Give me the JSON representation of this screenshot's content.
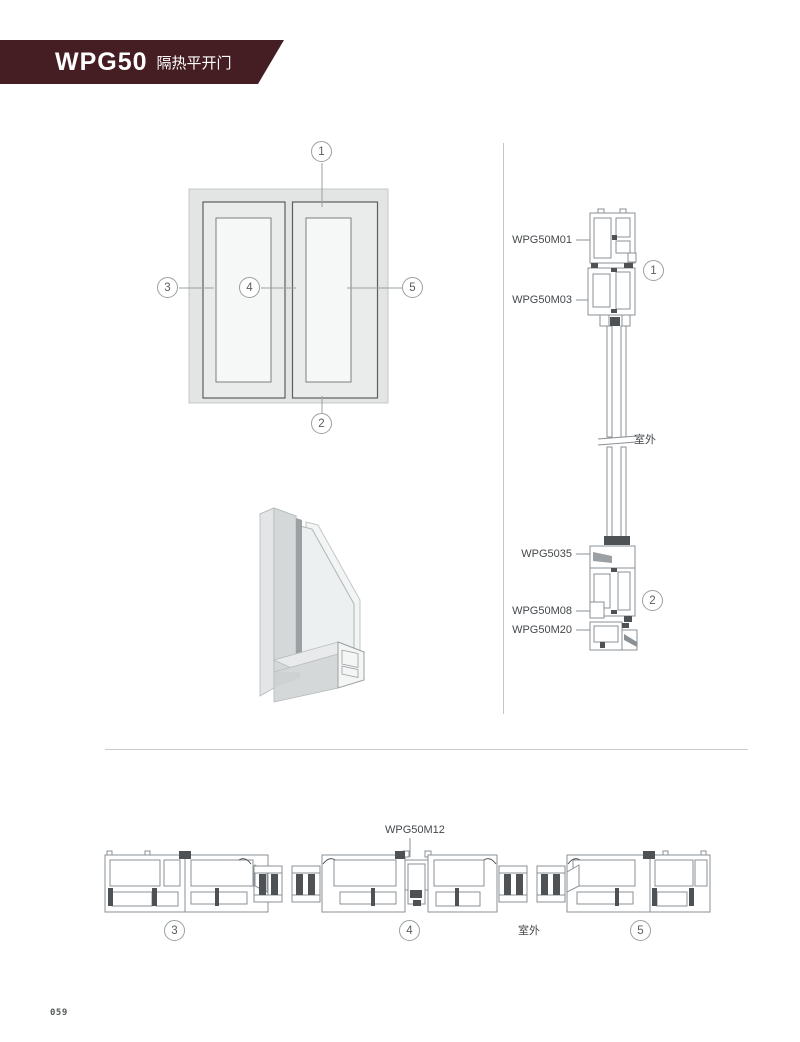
{
  "header": {
    "model": "WPG50",
    "subtitle": "隔热平开门"
  },
  "footer": {
    "page_number": "059"
  },
  "elevation": {
    "callouts": {
      "top": "1",
      "bottom": "2",
      "left": "3",
      "middle": "4",
      "right": "5"
    }
  },
  "vertical_section": {
    "labels": {
      "m01": "WPG50M01",
      "m03": "WPG50M03",
      "outdoor": "室外",
      "s5035": "WPG5035",
      "m08": "WPG50M08",
      "m20": "WPG50M20"
    },
    "callouts": {
      "top": "1",
      "bottom": "2"
    }
  },
  "horizontal_section": {
    "mullion_label": "WPG50M12",
    "outdoor": "室外",
    "callouts": {
      "left": "3",
      "middle": "4",
      "right": "5"
    }
  }
}
